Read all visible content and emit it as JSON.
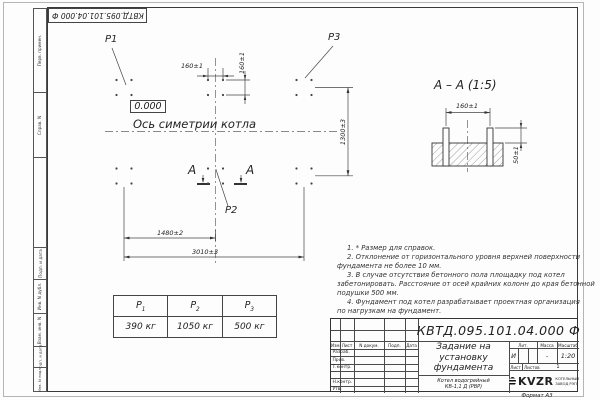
{
  "sheet": {
    "top_stamp": "КВТД.095.101.04.000 Ф",
    "format_label": "Формат А3"
  },
  "side_strip": {
    "cells": [
      "Перв. примен.",
      "Справ. N",
      "Подп. и дата",
      "Инв. N дубл.",
      "Взам. инв. N",
      "Подп. и дата",
      "Инв. N подл."
    ]
  },
  "plan": {
    "labels": {
      "p1": "Р1",
      "p2": "Р2",
      "p3": "Р3"
    },
    "elevation": "0.000",
    "axis_label": "Ось симетрии котла",
    "section_letter": "А",
    "dims": {
      "bolt_spacing_h": "160±1",
      "bolt_spacing_v": "160±1",
      "left_to_center": "1480±2",
      "total_width": "3010±3",
      "depth": "1300±3"
    }
  },
  "section_view": {
    "title": "А – А (1:5)",
    "dims": {
      "bolt_spacing": "160±1",
      "protrusion": "50±1"
    }
  },
  "loads_table": {
    "columns": [
      {
        "symbol": "Р",
        "index": "1",
        "value": "390 кг"
      },
      {
        "symbol": "Р",
        "index": "2",
        "value": "1050 кг"
      },
      {
        "symbol": "Р",
        "index": "3",
        "value": "500 кг"
      }
    ]
  },
  "notes": {
    "lines": [
      "1. * Размер для справок.",
      "2. Отклонение от горизонтального уровня верхней поверхности",
      "фундамента не более 10 мм.",
      "3. В случае отсутствия бетонного пола площадку под котел",
      "забетонировать. Расстояние от осей крайних колонн до края бетонной",
      "подушки 500 мм.",
      "4. Фундамент под котел разрабатывает проектная организация",
      "по нагрузкам на фундамент."
    ]
  },
  "title_block": {
    "designation": "КВТД.095.101.04.000 Ф",
    "doc_title": "Задание на установку фундамента",
    "product": "Котел водогрейный КВ-1,1 Д (РВР)",
    "col_headers": {
      "izm": "Изм.",
      "list": "Лист",
      "ndoc": "N докум.",
      "podp": "Подп.",
      "data": "Дата"
    },
    "row_labels": [
      "Разраб.",
      "Пров.",
      "Т.контр.",
      "",
      "Н.контр.",
      "Утв."
    ],
    "lit_header": "Лит.",
    "mass_header": "Масса",
    "scale_header": "Масштаб",
    "lit_value": "И",
    "mass_value": "-",
    "scale_value": "1:20",
    "sheet_label": "Лист",
    "sheets_label": "Листов",
    "sheets_value": "1",
    "logo": {
      "text": "KVZR",
      "caption_line1": "КОТЕЛЬНЫЙ",
      "caption_line2": "ЗАВОД РЭП"
    }
  }
}
